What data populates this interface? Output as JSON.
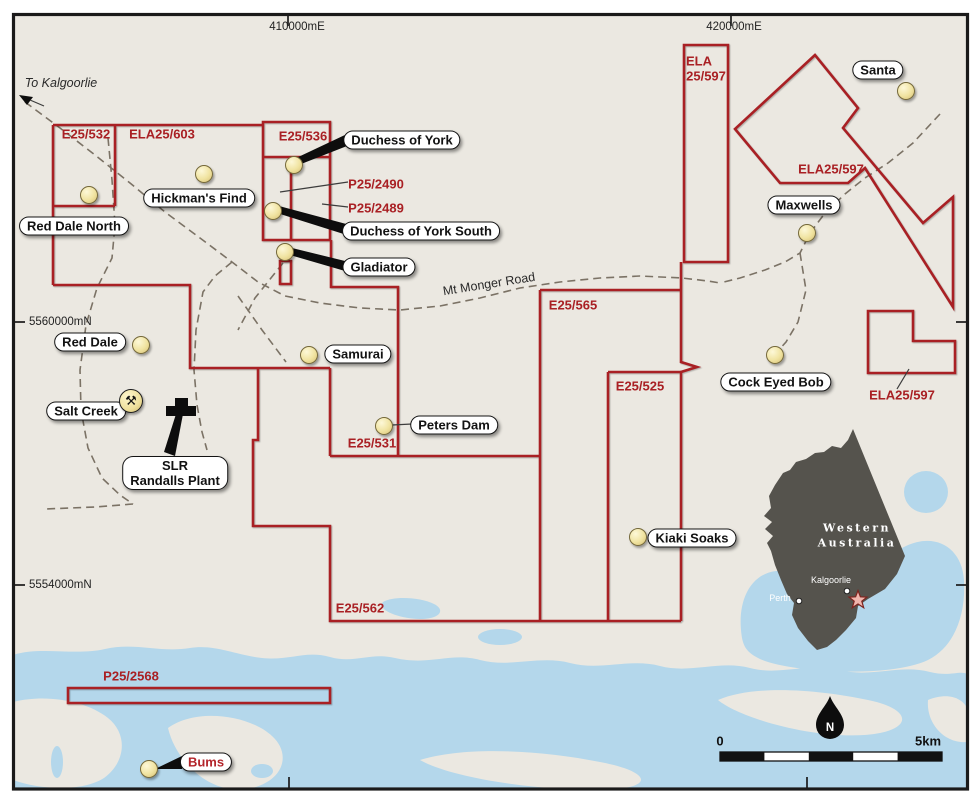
{
  "map": {
    "colors": {
      "map_bg": "#ebe8e1",
      "water": "#b4d7eb",
      "tenement_red": "#a92024",
      "road": "#7b7265",
      "inset_land": "#55534d",
      "marker_yellow": "#f0e3a0",
      "star_pink": "#f0b5ad"
    },
    "grid": {
      "top": [
        {
          "label": "410000mE",
          "x": 297
        },
        {
          "label": "420000mE",
          "x": 734
        }
      ],
      "left": [
        {
          "label": "5560000mN",
          "y": 322
        },
        {
          "label": "5554000mN",
          "y": 585
        }
      ]
    },
    "tenement_labels": [
      {
        "text": "E25/532",
        "x": 86,
        "y": 134
      },
      {
        "text": "ELA25/603",
        "x": 162,
        "y": 134
      },
      {
        "text": "E25/536",
        "x": 303,
        "y": 136
      },
      {
        "text": "P25/2490",
        "x": 376,
        "y": 184
      },
      {
        "text": "P25/2489",
        "x": 376,
        "y": 208
      },
      {
        "text": "ELA",
        "x": 699,
        "y": 61
      },
      {
        "text": "25/597",
        "x": 706,
        "y": 76
      },
      {
        "text": "ELA25/597",
        "x": 831,
        "y": 169
      },
      {
        "text": "E25/565",
        "x": 573,
        "y": 305
      },
      {
        "text": "E25/525",
        "x": 640,
        "y": 386
      },
      {
        "text": "E25/531",
        "x": 372,
        "y": 443
      },
      {
        "text": "E25/562",
        "x": 360,
        "y": 608
      },
      {
        "text": "ELA25/597",
        "x": 902,
        "y": 395
      },
      {
        "text": "P25/2568",
        "x": 131,
        "y": 676
      }
    ],
    "road_labels": [
      {
        "text": "To Kalgoorlie",
        "x": 61,
        "y": 83,
        "italic": true,
        "rotate": 0
      },
      {
        "text": "Mt Monger Road",
        "x": 489,
        "y": 284,
        "italic": false,
        "rotate": -9
      }
    ],
    "sites": [
      {
        "name": "Red Dale North",
        "lines": [
          "Red Dale North"
        ],
        "label_xy": [
          74,
          226
        ],
        "dot": [
          88,
          194
        ],
        "text_color": "black"
      },
      {
        "name": "Hickman's Find",
        "lines": [
          "Hickman's Find"
        ],
        "label_xy": [
          199,
          198
        ],
        "dot": [
          203,
          173
        ],
        "text_color": "black"
      },
      {
        "name": "Duchess of York",
        "lines": [
          "Duchess of York"
        ],
        "label_xy": [
          402,
          140
        ],
        "dot": [
          293,
          164
        ],
        "text_color": "black"
      },
      {
        "name": "Duchess of York South",
        "lines": [
          "Duchess of York South"
        ],
        "label_xy": [
          421,
          231
        ],
        "dot": [
          272,
          210
        ],
        "text_color": "black"
      },
      {
        "name": "Gladiator",
        "lines": [
          "Gladiator"
        ],
        "label_xy": [
          379,
          267
        ],
        "dot": [
          284,
          251
        ],
        "text_color": "black"
      },
      {
        "name": "Samurai",
        "lines": [
          "Samurai"
        ],
        "label_xy": [
          358,
          354
        ],
        "dot": [
          308,
          354
        ],
        "text_color": "black"
      },
      {
        "name": "Peters Dam",
        "lines": [
          "Peters Dam"
        ],
        "label_xy": [
          454,
          425
        ],
        "dot": [
          383,
          425
        ],
        "text_color": "black"
      },
      {
        "name": "Red Dale",
        "lines": [
          "Red Dale"
        ],
        "label_xy": [
          90,
          342
        ],
        "dot": [
          140,
          344
        ],
        "text_color": "black"
      },
      {
        "name": "Salt Creek",
        "lines": [
          "Salt Creek"
        ],
        "label_xy": [
          86,
          411
        ],
        "dot": null,
        "text_color": "black"
      },
      {
        "name": "SLR Randalls Plant",
        "lines": [
          "SLR",
          "Randalls Plant"
        ],
        "label_xy": [
          175,
          473
        ],
        "dot": null,
        "text_color": "black"
      },
      {
        "name": "Maxwells",
        "lines": [
          "Maxwells"
        ],
        "label_xy": [
          804,
          205
        ],
        "dot": [
          806,
          232
        ],
        "text_color": "black"
      },
      {
        "name": "Cock Eyed Bob",
        "lines": [
          "Cock Eyed Bob"
        ],
        "label_xy": [
          776,
          382
        ],
        "dot": [
          774,
          354
        ],
        "text_color": "black"
      },
      {
        "name": "Kiaki Soaks",
        "lines": [
          "Kiaki Soaks"
        ],
        "label_xy": [
          692,
          538
        ],
        "dot": [
          637,
          536
        ],
        "text_color": "black"
      },
      {
        "name": "Santa",
        "lines": [
          "Santa"
        ],
        "label_xy": [
          878,
          70
        ],
        "dot": [
          905,
          90
        ],
        "text_color": "black"
      },
      {
        "name": "Bums",
        "lines": [
          "Bums"
        ],
        "label_xy": [
          206,
          762
        ],
        "dot": [
          148,
          768
        ],
        "text_color": "red"
      }
    ],
    "mine_icons": [
      {
        "type": "crossed-hammers",
        "glyph": "⚒",
        "x": 142,
        "y": 412
      },
      {
        "type": "processing-plant",
        "x": 181,
        "y": 406
      }
    ],
    "inset": {
      "region_lines": [
        "Western",
        "Australia"
      ],
      "title_center": [
        857,
        528
      ],
      "line_height": 15,
      "cities": [
        {
          "name": "Kalgoorlie",
          "label": [
            831,
            580
          ],
          "dot": [
            847,
            591
          ]
        },
        {
          "name": "Perth",
          "label": [
            780,
            598
          ],
          "dot": [
            799,
            601
          ]
        }
      ],
      "project_star": [
        858,
        600
      ]
    },
    "scalebar": {
      "zero": "0",
      "end": "5km",
      "zero_xy": [
        720,
        741
      ],
      "end_xy": [
        928,
        741
      ]
    },
    "north_arrow": {
      "letter": "N",
      "xy": [
        830,
        728
      ]
    }
  }
}
